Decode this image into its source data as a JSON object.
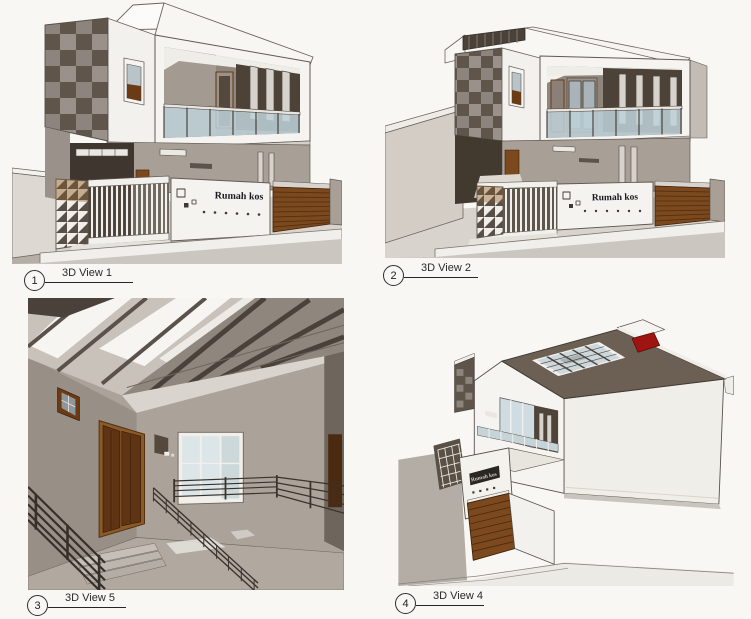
{
  "sheet": {
    "background": "#f8f7f4",
    "sign_text": "Rumah kos"
  },
  "views": [
    {
      "bubble": "1",
      "label": "3D View 1"
    },
    {
      "bubble": "2",
      "label": "3D View 2"
    },
    {
      "bubble": "3",
      "label": "3D View 5"
    },
    {
      "bubble": "4",
      "label": "3D View 4"
    }
  ],
  "palette": {
    "wall_white": "#f5f3ef",
    "wall_taupe": "#a8a097",
    "tile_dark": "#60554b",
    "tile_light": "#99918a",
    "accent_dark_wall": "#4c4238",
    "wood_brown": "#7b491d",
    "glass_blue": "#c2d4da",
    "roof_dark": "#6b6053",
    "accent_red": "#9e1410",
    "ground_gray": "#b5aea6",
    "line_color": "#262626"
  }
}
